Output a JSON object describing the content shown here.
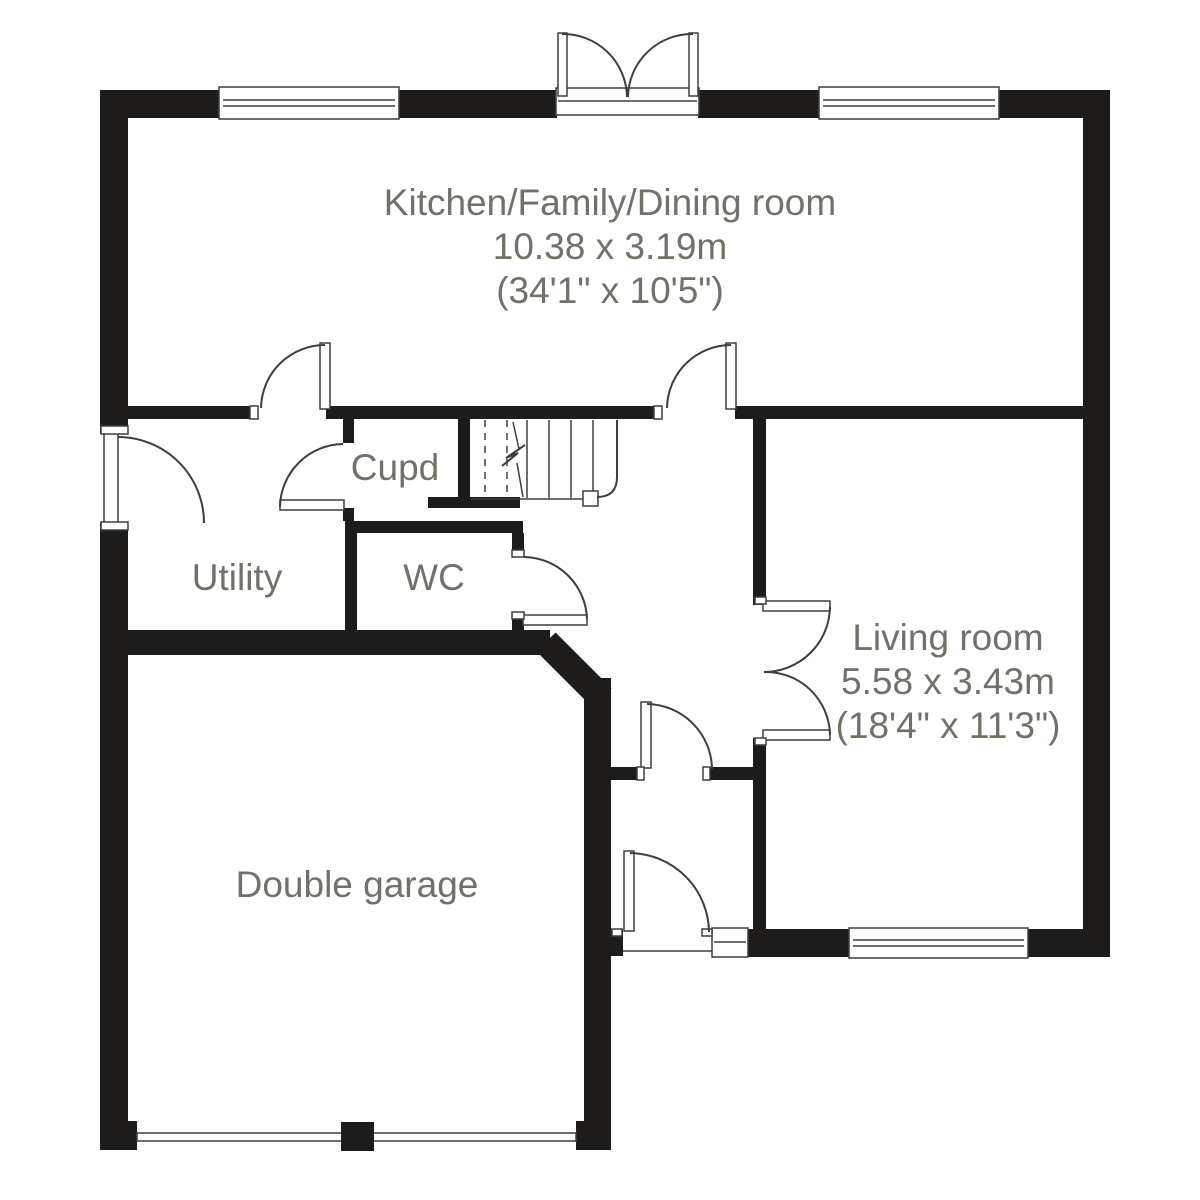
{
  "colors": {
    "paper": "#ffffff",
    "wall": "#1d1c1a",
    "line": "#3e3e3c",
    "text": "#6e7267"
  },
  "typography": {
    "size": 37,
    "line_height": 44
  },
  "rooms": [
    {
      "id": "kitchen",
      "label": "Kitchen/Family/Dining room",
      "dim_m": "10.38 x 3.19m",
      "dim_ft": "(34'1\" x 10'5\")",
      "x": 610,
      "y": 215
    },
    {
      "id": "living-room",
      "label": "Living room",
      "dim_m": "5.58 x 3.43m",
      "dim_ft": "(18'4\" x 11'3\")",
      "x": 948,
      "y": 650
    },
    {
      "id": "double-garage",
      "label": "Double garage",
      "dim_m": null,
      "dim_ft": null,
      "x": 357,
      "y": 897
    },
    {
      "id": "cupboard",
      "label": "Cupd",
      "dim_m": null,
      "dim_ft": null,
      "x": 395,
      "y": 480
    },
    {
      "id": "utility",
      "label": "Utility",
      "dim_m": null,
      "dim_ft": null,
      "x": 237,
      "y": 590
    },
    {
      "id": "wc",
      "label": "WC",
      "dim_m": null,
      "dim_ft": null,
      "x": 434,
      "y": 590
    }
  ],
  "plan": {
    "walls": [
      {
        "n": "top-wall-a",
        "x": 100,
        "y": 90,
        "w": 120,
        "h": 28
      },
      {
        "n": "top-wall-b",
        "x": 398,
        "y": 90,
        "w": 159,
        "h": 28
      },
      {
        "n": "top-wall-c",
        "x": 698,
        "y": 90,
        "w": 122,
        "h": 28
      },
      {
        "n": "top-wall-d",
        "x": 998,
        "y": 90,
        "w": 112,
        "h": 28
      },
      {
        "n": "left-wall-upper",
        "x": 100,
        "y": 90,
        "w": 28,
        "h": 343
      },
      {
        "n": "left-wall-lower",
        "x": 100,
        "y": 523,
        "w": 28,
        "h": 600
      },
      {
        "n": "left-wall-foot",
        "x": 100,
        "y": 1121,
        "w": 37,
        "h": 29
      },
      {
        "n": "east-wall",
        "x": 1083,
        "y": 90,
        "w": 27,
        "h": 867
      },
      {
        "n": "living-south-wall-a",
        "x": 748,
        "y": 929,
        "w": 102,
        "h": 28
      },
      {
        "n": "living-south-wall-b",
        "x": 1027,
        "y": 929,
        "w": 83,
        "h": 28
      },
      {
        "n": "kitchen-south-wall-a",
        "x": 128,
        "y": 406,
        "w": 130,
        "h": 13
      },
      {
        "n": "kitchen-south-wall-b",
        "x": 326,
        "y": 406,
        "w": 336,
        "h": 13
      },
      {
        "n": "kitchen-south-wall-c",
        "x": 735,
        "y": 406,
        "w": 348,
        "h": 13
      },
      {
        "n": "stairs-west-wall",
        "x": 458,
        "y": 419,
        "w": 12,
        "h": 81
      },
      {
        "n": "cupboard-south-wall",
        "x": 428,
        "y": 497,
        "w": 92,
        "h": 11
      },
      {
        "n": "hall-south-wall",
        "x": 345,
        "y": 521,
        "w": 178,
        "h": 12
      },
      {
        "n": "cupboard-stub-upper",
        "x": 343,
        "y": 419,
        "w": 11,
        "h": 24
      },
      {
        "n": "cupboard-stub-lower",
        "x": 343,
        "y": 508,
        "w": 11,
        "h": 13
      },
      {
        "n": "utility-wc-wall",
        "x": 345,
        "y": 533,
        "w": 12,
        "h": 122
      },
      {
        "n": "wc-east-wall-upper",
        "x": 512,
        "y": 533,
        "w": 12,
        "h": 24
      },
      {
        "n": "wc-east-wall-lower",
        "x": 512,
        "y": 619,
        "w": 12,
        "h": 36
      },
      {
        "n": "living-west-wall-upper",
        "x": 753,
        "y": 419,
        "w": 13,
        "h": 186
      },
      {
        "n": "living-west-wall-lower",
        "x": 753,
        "y": 738,
        "w": 13,
        "h": 192
      },
      {
        "n": "corridor-north-wall-a",
        "x": 607,
        "y": 767,
        "w": 30,
        "h": 13
      },
      {
        "n": "corridor-north-wall-b",
        "x": 710,
        "y": 767,
        "w": 43,
        "h": 13
      },
      {
        "n": "garage-north-wall",
        "x": 128,
        "y": 630,
        "w": 422,
        "h": 25
      },
      {
        "n": "garage-east-wall",
        "x": 584,
        "y": 678,
        "w": 27,
        "h": 472
      },
      {
        "n": "garage-east-wall-foot",
        "x": 576,
        "y": 1121,
        "w": 35,
        "h": 29
      },
      {
        "n": "backdoor-jamb-wall",
        "x": 611,
        "y": 929,
        "w": 12,
        "h": 27
      }
    ],
    "chamfers": [
      {
        "n": "garage-chamfer-wall",
        "d": "M 546 642 L 602 698",
        "w": 27
      }
    ],
    "white_rects": [
      {
        "n": "garage-door",
        "x": 137,
        "y": 1133,
        "w": 439,
        "h": 8
      },
      {
        "n": "window-top-left",
        "x": 219,
        "y": 87,
        "w": 180,
        "h": 32
      },
      {
        "n": "window-top-right",
        "x": 819,
        "y": 87,
        "w": 180,
        "h": 32
      },
      {
        "n": "window-living-south",
        "x": 849,
        "y": 928,
        "w": 179,
        "h": 30
      },
      {
        "n": "french-door-sill",
        "x": 556,
        "y": 88,
        "w": 143,
        "h": 27
      },
      {
        "n": "backdoor-sidelight",
        "x": 712,
        "y": 928,
        "w": 36,
        "h": 29
      },
      {
        "n": "front-door-leaf",
        "x": 104,
        "y": 433,
        "w": 14,
        "h": 90
      },
      {
        "n": "kitchen-door-a-leaf",
        "x": 320,
        "y": 343,
        "w": 10,
        "h": 66
      },
      {
        "n": "kitchen-door-b-leaf",
        "x": 726,
        "y": 343,
        "w": 10,
        "h": 66
      },
      {
        "n": "cupboard-door-leaf",
        "x": 280,
        "y": 500,
        "w": 64,
        "h": 10
      },
      {
        "n": "wc-door-leaf",
        "x": 523,
        "y": 615,
        "w": 64,
        "h": 10
      },
      {
        "n": "living-door-upper-leaf",
        "x": 763,
        "y": 601,
        "w": 67,
        "h": 10
      },
      {
        "n": "living-door-lower-leaf",
        "x": 763,
        "y": 730,
        "w": 67,
        "h": 10
      },
      {
        "n": "corridor-door-leaf",
        "x": 641,
        "y": 702,
        "w": 10,
        "h": 66
      },
      {
        "n": "back-door-leaf",
        "x": 624,
        "y": 851,
        "w": 10,
        "h": 80
      },
      {
        "n": "french-door-left-leaf",
        "x": 558,
        "y": 33,
        "w": 9,
        "h": 63
      },
      {
        "n": "french-door-right-leaf",
        "x": 689,
        "y": 33,
        "w": 9,
        "h": 63
      },
      {
        "n": "stairs-newel",
        "x": 583,
        "y": 491,
        "w": 15,
        "h": 15
      },
      {
        "n": "door-jamb",
        "x": 250,
        "y": 406,
        "w": 8,
        "h": 13
      },
      {
        "n": "door-jamb",
        "x": 654,
        "y": 406,
        "w": 8,
        "h": 13
      },
      {
        "n": "door-jamb",
        "x": 637,
        "y": 767,
        "w": 7,
        "h": 13
      },
      {
        "n": "door-jamb",
        "x": 703,
        "y": 767,
        "w": 7,
        "h": 13
      },
      {
        "n": "door-jamb",
        "x": 512,
        "y": 550,
        "w": 12,
        "h": 7
      },
      {
        "n": "door-jamb",
        "x": 512,
        "y": 612,
        "w": 12,
        "h": 7
      },
      {
        "n": "door-jamb",
        "x": 755,
        "y": 597,
        "w": 11,
        "h": 7
      },
      {
        "n": "door-jamb",
        "x": 755,
        "y": 738,
        "w": 11,
        "h": 7
      },
      {
        "n": "door-jamb",
        "x": 101,
        "y": 426,
        "w": 27,
        "h": 8
      },
      {
        "n": "door-jamb",
        "x": 101,
        "y": 522,
        "w": 27,
        "h": 8
      },
      {
        "n": "door-jamb",
        "x": 612,
        "y": 929,
        "w": 10,
        "h": 7
      },
      {
        "n": "door-jamb",
        "x": 702,
        "y": 929,
        "w": 10,
        "h": 7
      }
    ],
    "walls_top": [
      {
        "n": "garage-door-pier",
        "x": 341,
        "y": 1122,
        "w": 33,
        "h": 29
      }
    ],
    "lines": [
      {
        "n": "window-glazing",
        "x1": 223,
        "y1": 100,
        "x2": 395,
        "y2": 100
      },
      {
        "n": "window-glazing",
        "x1": 223,
        "y1": 106,
        "x2": 395,
        "y2": 106
      },
      {
        "n": "window-glazing",
        "x1": 823,
        "y1": 100,
        "x2": 995,
        "y2": 100
      },
      {
        "n": "window-glazing",
        "x1": 823,
        "y1": 106,
        "x2": 995,
        "y2": 106
      },
      {
        "n": "window-glazing",
        "x1": 853,
        "y1": 940,
        "x2": 1024,
        "y2": 940
      },
      {
        "n": "window-glazing",
        "x1": 853,
        "y1": 946,
        "x2": 1024,
        "y2": 946
      },
      {
        "n": "french-door-sill-line",
        "x1": 558,
        "y1": 101,
        "x2": 697,
        "y2": 101
      },
      {
        "n": "sidelight-glazing",
        "x1": 714,
        "y1": 942,
        "x2": 746,
        "y2": 942
      },
      {
        "n": "backdoor-threshold",
        "x1": 623,
        "y1": 951,
        "x2": 712,
        "y2": 951
      },
      {
        "n": "stair-tread",
        "x1": 527,
        "y1": 420,
        "x2": 527,
        "y2": 498
      },
      {
        "n": "stair-tread",
        "x1": 549,
        "y1": 420,
        "x2": 549,
        "y2": 498
      },
      {
        "n": "stair-tread",
        "x1": 571,
        "y1": 420,
        "x2": 571,
        "y2": 498
      },
      {
        "n": "stair-tread",
        "x1": 593,
        "y1": 420,
        "x2": 593,
        "y2": 491
      },
      {
        "n": "stair-tread-hidden",
        "x1": 485,
        "y1": 420,
        "x2": 485,
        "y2": 499,
        "dash": "7,6"
      },
      {
        "n": "stair-tread-hidden",
        "x1": 507,
        "y1": 420,
        "x2": 507,
        "y2": 499,
        "dash": "7,6"
      },
      {
        "n": "stairs-bottom-edge",
        "x1": 471,
        "y1": 499,
        "x2": 583,
        "y2": 499
      },
      {
        "n": "stairs-direction-line",
        "x1": 513,
        "y1": 422,
        "x2": 519,
        "y2": 449
      },
      {
        "n": "stairs-direction-line",
        "x1": 517,
        "y1": 463,
        "x2": 523,
        "y2": 497
      }
    ],
    "arcs": [
      {
        "n": "front-door-swing",
        "d": "M 118 437 A 86 86 0 0 1 204 523"
      },
      {
        "n": "kitchen-door-a-swing",
        "d": "M 325 345 A 64 64 0 0 0 261 408"
      },
      {
        "n": "kitchen-door-b-swing",
        "d": "M 731 345 A 64 64 0 0 0 667 408"
      },
      {
        "n": "cupboard-door-swing",
        "d": "M 280 507 A 64 64 0 0 1 343 444"
      },
      {
        "n": "wc-door-swing",
        "d": "M 587 619 A 64 64 0 0 0 524 557"
      },
      {
        "n": "living-door-upper-swing",
        "d": "M 830 607 A 66 66 0 0 1 764 672"
      },
      {
        "n": "living-door-lower-swing",
        "d": "M 830 735 A 64 64 0 0 0 764 672"
      },
      {
        "n": "corridor-door-swing",
        "d": "M 647 704 A 66 66 0 0 1 712 769"
      },
      {
        "n": "back-door-swing",
        "d": "M 630 853 A 80 80 0 0 1 709 932"
      },
      {
        "n": "french-door-left-swing",
        "d": "M 562 34 A 64 64 0 0 1 627 97"
      },
      {
        "n": "french-door-right-swing",
        "d": "M 693 34 A 64 64 0 0 0 628 97"
      },
      {
        "n": "stairs-handrail",
        "d": "M 617 420 L 617 477 Q 617 497 597 497"
      },
      {
        "n": "stairs-direction-break",
        "d": "M 525 445 L 506 458 L 518 453 L 502 466"
      }
    ]
  }
}
